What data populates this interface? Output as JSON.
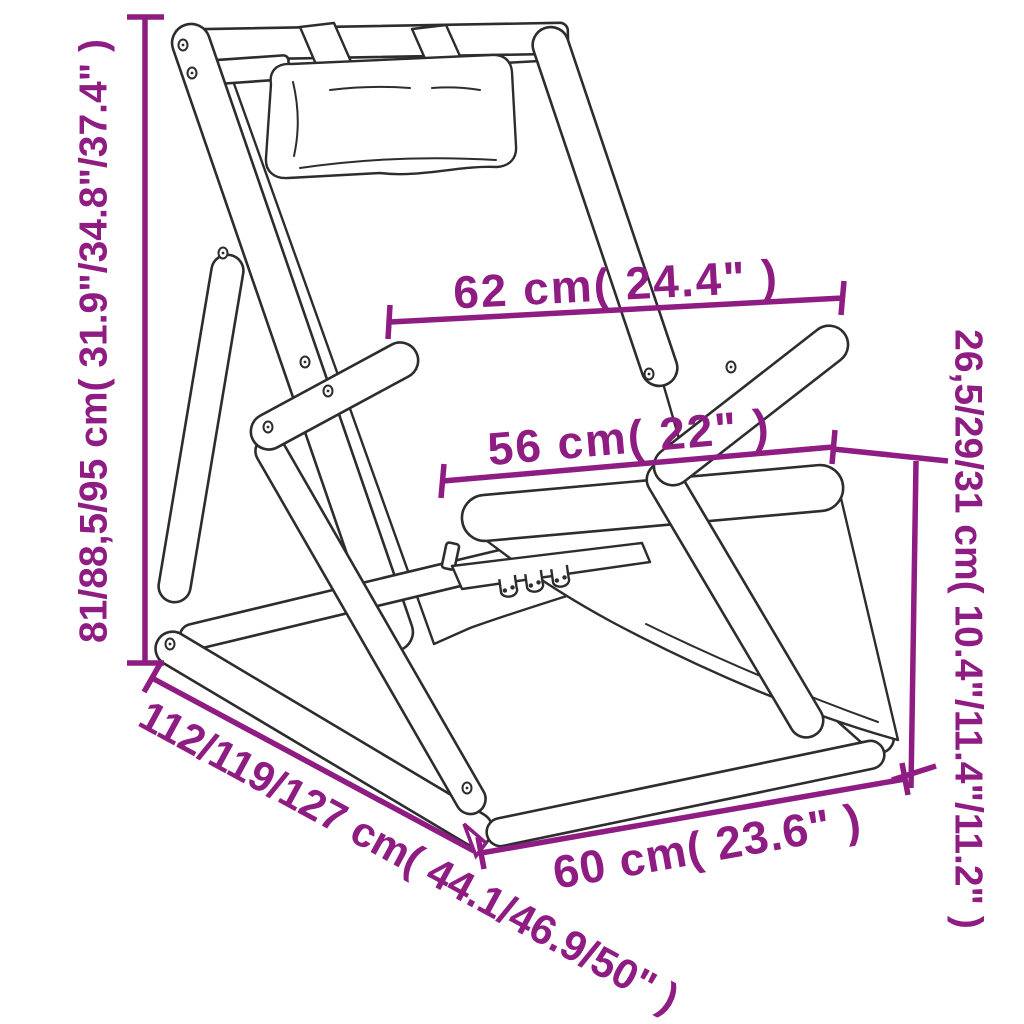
{
  "diagram": {
    "subject": "Folding wooden deck chair with headrest pillow, shown as technical line drawing with dimension callouts",
    "accent_color": "#8E1C83",
    "line_color": "#2D2D2D",
    "background_color": "#FFFFFF",
    "dimensions": [
      {
        "id": "overall-height",
        "label": "81/88,5/95 cm( 31.9\"/34.8\"/37.4\" )",
        "values_cm": [
          81,
          88.5,
          95
        ],
        "values_in": [
          31.9,
          34.8,
          37.4
        ],
        "orientation": "vertical-left"
      },
      {
        "id": "armrest-width",
        "label": "62 cm( 24.4\" )",
        "values_cm": [
          62
        ],
        "values_in": [
          24.4
        ],
        "orientation": "horizontal-upper"
      },
      {
        "id": "seat-width",
        "label": "56 cm( 22\" )",
        "values_cm": [
          56
        ],
        "values_in": [
          22
        ],
        "orientation": "horizontal-middle"
      },
      {
        "id": "seat-height",
        "label": "26,5/29/31 cm( 10.4\"/11.4\"/11.2\" )",
        "values_cm": [
          26.5,
          29,
          31
        ],
        "values_in": [
          10.4,
          11.4,
          11.2
        ],
        "orientation": "vertical-right"
      },
      {
        "id": "overall-depth",
        "label": "112/119/127 cm( 44.1/46.9/50\" )",
        "values_cm": [
          112,
          119,
          127
        ],
        "values_in": [
          44.1,
          46.9,
          50
        ],
        "orientation": "diagonal-lower-left"
      },
      {
        "id": "base-width",
        "label": "60 cm( 23.6\" )",
        "values_cm": [
          60
        ],
        "values_in": [
          23.6
        ],
        "orientation": "diagonal-bottom"
      }
    ]
  }
}
